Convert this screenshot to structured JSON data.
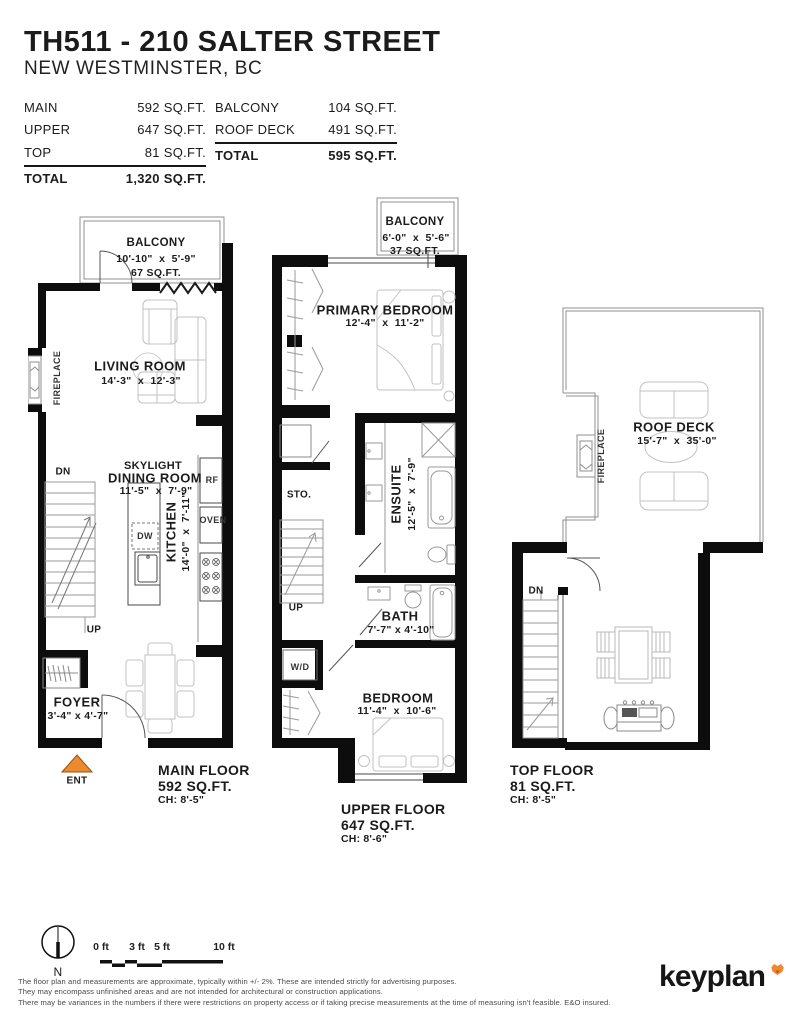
{
  "header": {
    "title": "TH511 - 210 SALTER STREET",
    "subtitle": "NEW WESTMINSTER, BC"
  },
  "area_tables": {
    "left": {
      "rows": [
        {
          "label": "MAIN",
          "value": "592 SQ.FT."
        },
        {
          "label": "UPPER",
          "value": "647 SQ.FT."
        },
        {
          "label": "TOP",
          "value": "81 SQ.FT."
        }
      ],
      "total_label": "TOTAL",
      "total_value": "1,320 SQ.FT."
    },
    "right": {
      "rows": [
        {
          "label": "BALCONY",
          "value": "104 SQ.FT."
        },
        {
          "label": "ROOF DECK",
          "value": "491 SQ.FT."
        }
      ],
      "total_label": "TOTAL",
      "total_value": "595 SQ.FT."
    }
  },
  "main_floor": {
    "balcony": {
      "name": "BALCONY",
      "dims": "10'-10\"  x  5'-9\"",
      "area": "67 SQ.FT."
    },
    "living_room": {
      "name": "LIVING ROOM",
      "dims": "14'-3\"  x  12'-3\""
    },
    "fireplace": "FIREPLACE",
    "dn": "DN",
    "up": "UP",
    "kitchen": {
      "name": "KITCHEN",
      "dims": "14'-0\"  x  7'-11\""
    },
    "rf": "RF",
    "oven": "OVEN",
    "dw": "DW",
    "dining": {
      "skylight": "SKYLIGHT",
      "name": "DINING ROOM",
      "dims": "11'-5\"  x  7'-9\""
    },
    "foyer": {
      "name": "FOYER",
      "dims": "3'-4\" x 4'-7\""
    },
    "ent": "ENT",
    "caption": {
      "line1": "MAIN FLOOR",
      "line2": "592 SQ.FT.",
      "line3": "CH: 8'-5\""
    }
  },
  "upper_floor": {
    "balcony": {
      "name": "BALCONY",
      "dims": "6'-0\"  x  5'-6\"",
      "area": "37 SQ.FT."
    },
    "primary_bedroom": {
      "name": "PRIMARY BEDROOM",
      "dims": "12'-4\"  x  11'-2\""
    },
    "sto": "STO.",
    "ensuite": {
      "name": "ENSUITE",
      "dims": "12'-5\"  x  7'-9\""
    },
    "up": "UP",
    "bath": {
      "name": "BATH",
      "dims": "7'-7\" x 4'-10\""
    },
    "wd": "W/D",
    "bedroom": {
      "name": "BEDROOM",
      "dims": "11'-4\"  x  10'-6\""
    },
    "caption": {
      "line1": "UPPER FLOOR",
      "line2": "647 SQ.FT.",
      "line3": "CH: 8'-6\""
    }
  },
  "top_floor": {
    "roof_deck": {
      "name": "ROOF DECK",
      "dims": "15'-7\"  x  35'-0\""
    },
    "fireplace": "FIREPLACE",
    "dn": "DN",
    "caption": {
      "line1": "TOP FLOOR",
      "line2": "81 SQ.FT.",
      "line3": "CH: 8'-5\""
    }
  },
  "scale_bar": {
    "labels": [
      "0 ft",
      "3 ft",
      "5 ft",
      "10 ft"
    ]
  },
  "north_label": "N",
  "footer": {
    "disclaimer_lines": [
      "The floor plan and measurements are approximate, typically within +/- 2%. These are intended strictly for advertising purposes.",
      "They may encompass unfinished areas and are not intended for architectural or construction applications.",
      "There may be variances in the numbers if there were restrictions on property access or if taking precise measurements at the time of measuring isn't feasible. E&O insured."
    ],
    "brand": "keyplan"
  },
  "colors": {
    "wall_black": "#0D0D0D",
    "furniture_gray": "#C2C2C2",
    "fixture_gray": "#9A9A9A",
    "accent_orange": "#EE8A2E"
  }
}
